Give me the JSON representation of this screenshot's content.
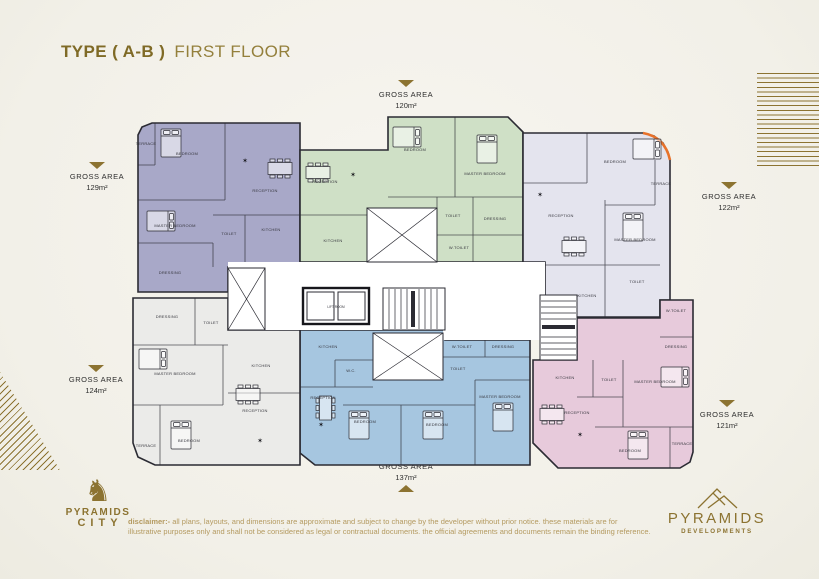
{
  "title": {
    "bold": "TYPE ( A-B )",
    "regular": "FIRST FLOOR"
  },
  "colors": {
    "gold": "#8c7331",
    "wall": "#2b2b33",
    "accent_arc": "#e8722a",
    "background": "#f4f2ec"
  },
  "gross_areas": [
    {
      "position": "top-center",
      "label": "GROSS AREA",
      "value": "120m²",
      "arrow": "down"
    },
    {
      "position": "left-top",
      "label": "GROSS AREA",
      "value": "129m²",
      "arrow": "down"
    },
    {
      "position": "right-top",
      "label": "GROSS AREA",
      "value": "122m²",
      "arrow": "down"
    },
    {
      "position": "left-bottom",
      "label": "GROSS AREA",
      "value": "124m²",
      "arrow": "down"
    },
    {
      "position": "right-bottom",
      "label": "GROSS AREA",
      "value": "121m²",
      "arrow": "down"
    },
    {
      "position": "bottom-center",
      "label": "GROSS AREA",
      "value": "137m²",
      "arrow": "up"
    }
  ],
  "plan": {
    "wall_color": "#2b2b33",
    "core": {
      "lift_label": "LIFT ROOM"
    },
    "units": [
      {
        "id": "unit-top-left-129",
        "color": "#a8a8c8",
        "outline": "13,187 13,30 17,22 27,18 175,18 175,162 103,162 103,187",
        "rooms": [
          {
            "t": "TERRACE",
            "x": 21,
            "y": 40
          },
          {
            "t": "BEDROOM",
            "x": 62,
            "y": 50
          },
          {
            "t": "RECEPTION",
            "x": 140,
            "y": 87
          },
          {
            "t": "MASTER BEDROOM",
            "x": 50,
            "y": 122
          },
          {
            "t": "TOILET",
            "x": 104,
            "y": 130
          },
          {
            "t": "KITCHEN",
            "x": 146,
            "y": 126
          },
          {
            "t": "DRESSING",
            "x": 45,
            "y": 169
          }
        ]
      },
      {
        "id": "unit-top-center-120",
        "color": "#cfe0c6",
        "outline": "175,45 263,45 263,12 383,12 398,27 398,157 175,157",
        "rooms": [
          {
            "t": "RECEPTION",
            "x": 200,
            "y": 78
          },
          {
            "t": "BEDROOM",
            "x": 290,
            "y": 46
          },
          {
            "t": "MASTER BEDROOM",
            "x": 360,
            "y": 70
          },
          {
            "t": "KITCHEN",
            "x": 208,
            "y": 137
          },
          {
            "t": "TOILET",
            "x": 328,
            "y": 112
          },
          {
            "t": "DRESSING",
            "x": 370,
            "y": 115
          },
          {
            "t": "W.TOILET",
            "x": 334,
            "y": 144
          }
        ]
      },
      {
        "id": "unit-top-right-122",
        "color": "#e4e4ee",
        "outline": "398,28 518,28 529,31 538,38 543,47 545,55 545,195 535,195 535,212 420,212 420,157 398,157",
        "rooms": [
          {
            "t": "BEDROOM",
            "x": 490,
            "y": 58
          },
          {
            "t": "TERRACE",
            "x": 536,
            "y": 80
          },
          {
            "t": "RECEPTION",
            "x": 436,
            "y": 112
          },
          {
            "t": "MASTER BEDROOM",
            "x": 510,
            "y": 136
          },
          {
            "t": "KITCHEN",
            "x": 462,
            "y": 192
          },
          {
            "t": "TOILET",
            "x": 512,
            "y": 178
          }
        ]
      },
      {
        "id": "unit-bottom-right-121",
        "color": "#e7cadb",
        "outline": "452,213 535,213 535,195 568,195 568,347 565,357 555,363 433,363 408,338 408,255 452,255",
        "rooms": [
          {
            "t": "W.TOILET",
            "x": 551,
            "y": 207
          },
          {
            "t": "DRESSING",
            "x": 551,
            "y": 243
          },
          {
            "t": "KITCHEN",
            "x": 440,
            "y": 274
          },
          {
            "t": "TOILET",
            "x": 484,
            "y": 276
          },
          {
            "t": "MASTER BEDROOM",
            "x": 530,
            "y": 278
          },
          {
            "t": "RECEPTION",
            "x": 452,
            "y": 309
          },
          {
            "t": "BEDROOM",
            "x": 505,
            "y": 347
          },
          {
            "t": "TERRACE",
            "x": 557,
            "y": 340
          }
        ]
      },
      {
        "id": "unit-bottom-center-137",
        "color": "#a6c6e0",
        "outline": "175,225 320,225 320,235 405,235 405,360 190,360 175,348",
        "rooms": [
          {
            "t": "KITCHEN",
            "x": 203,
            "y": 243
          },
          {
            "t": "W.C.",
            "x": 226,
            "y": 267
          },
          {
            "t": "RECEPTION",
            "x": 198,
            "y": 294
          },
          {
            "t": "BEDROOM",
            "x": 240,
            "y": 318
          },
          {
            "t": "BEDROOM",
            "x": 312,
            "y": 321
          },
          {
            "t": "MASTER BEDROOM",
            "x": 375,
            "y": 293
          },
          {
            "t": "W.TOILET",
            "x": 337,
            "y": 243
          },
          {
            "t": "TOILET",
            "x": 333,
            "y": 265
          },
          {
            "t": "DRESSING",
            "x": 378,
            "y": 243
          }
        ]
      },
      {
        "id": "unit-bottom-left-124",
        "color": "#ebebe9",
        "outline": "8,193 103,193 103,225 175,225 175,360 30,360 13,352 8,338",
        "rooms": [
          {
            "t": "DRESSING",
            "x": 42,
            "y": 213
          },
          {
            "t": "TOILET",
            "x": 86,
            "y": 219
          },
          {
            "t": "MASTER BEDROOM",
            "x": 50,
            "y": 270
          },
          {
            "t": "KITCHEN",
            "x": 136,
            "y": 262
          },
          {
            "t": "RECEPTION",
            "x": 130,
            "y": 307
          },
          {
            "t": "BEDROOM",
            "x": 64,
            "y": 337
          },
          {
            "t": "TERRACE",
            "x": 21,
            "y": 342
          }
        ]
      }
    ]
  },
  "footer": {
    "disclaimer_label": "disclaimer:-",
    "disclaimer_text": " all plans, layouts, and dimensions are approximate and subject to change by the developer without prior notice. these materials are for illustrative purposes only and shall not be considered as legal or contractual documents. the official agreements and documents remain the binding reference.",
    "logo_city": {
      "horse_icon": "♞",
      "name_top": "PYRAMIDS",
      "name_bottom": "CITY"
    },
    "logo_dev": {
      "name_top": "PYRAMIDS",
      "name_bottom": "DEVELOPMENTS"
    }
  }
}
